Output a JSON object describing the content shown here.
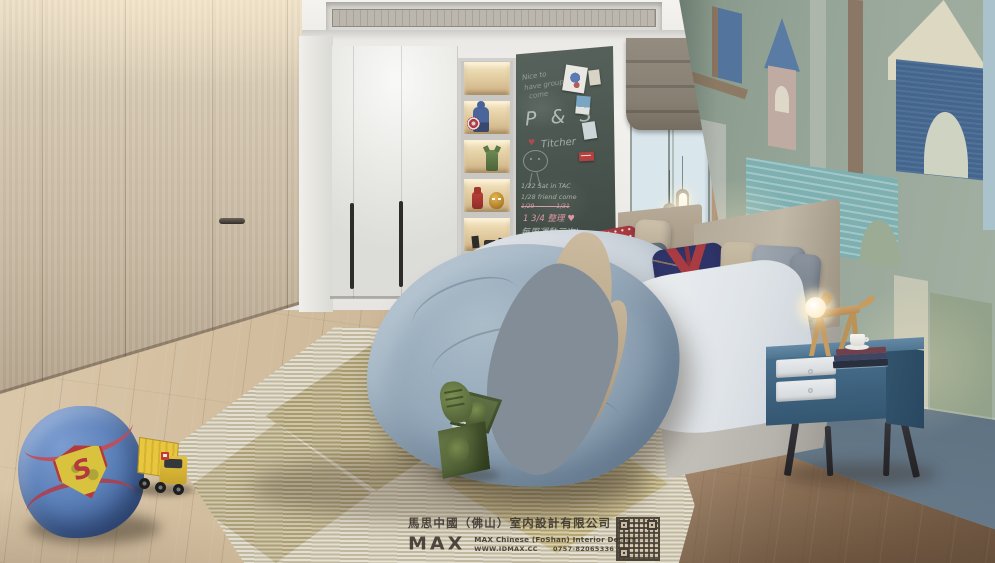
{
  "watermark": {
    "logo": "MAX",
    "company_cn": "馬思中國（佛山）室内設計有限公司",
    "company_en": "MAX Chinese (FoShan) Interior Design",
    "website": "WWW.IDMAX.CC",
    "phone": "0757-82065336"
  },
  "chalkboard": {
    "greeting_line1": "Nice to",
    "greeting_line2": "have group",
    "greeting_line3": "come",
    "initials": "P & S",
    "heart": "♥",
    "name": "Titcher",
    "note1": "1/22 Sat in TAC",
    "note2": "1/28 friend come",
    "note3_struck": "1/29 ——— 1/31",
    "note4": "1 3/4 整理 ♥",
    "note5": "每周運動三次!"
  },
  "beanbag": {
    "logo_letter": "S"
  },
  "palette": {
    "wood_wardrobe": "#cdc0ab",
    "white_wardrobe": "#e8e8e6",
    "chalkboard_green": "#4b5751",
    "mural_sage": "#9aa99b",
    "mural_blue": "#44668e",
    "mural_teal": "#7fb0b1",
    "nightstand_blue": "#3c607c",
    "duvet_blue_gray": "#93a7b8",
    "spiderman_pillow_navy": "#2e3368",
    "pillow_red": "#a83a3e",
    "rug_olive": "#a2924e",
    "beanbag_blue": "#5b80b8",
    "beanbag_red": "#c24b52",
    "truck_yellow": "#e3bf3a",
    "hulk_green": "#55663a",
    "floor_wood": "#c5ae92"
  }
}
